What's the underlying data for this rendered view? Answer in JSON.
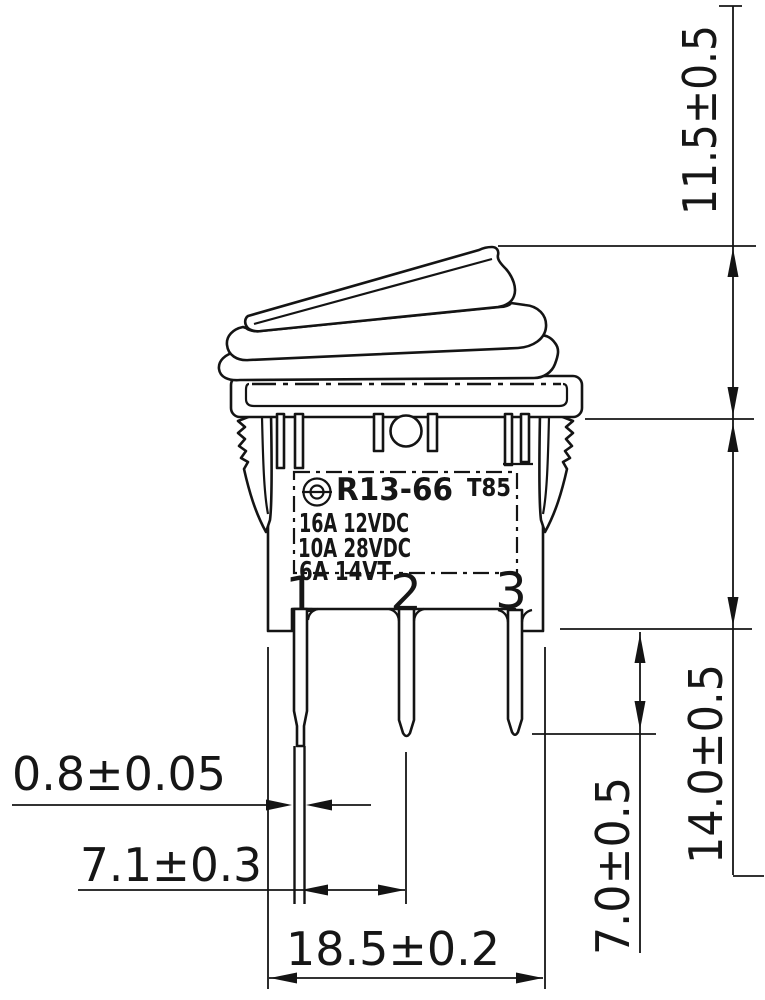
{
  "title": "R13-66 rocker switch dimensional drawing",
  "part_label": {
    "cert_mark": "approval-logo",
    "model": "R13-66",
    "temp_rating": "T85",
    "ratings": [
      "16A 12VDC",
      "10A 28VDC",
      "6A 14VT"
    ]
  },
  "terminals": {
    "t1": "1",
    "t2": "2",
    "t3": "3"
  },
  "dimensions": {
    "rocker_height": "11.5±0.5",
    "body_depth": "14.0±0.5",
    "terminal_length": "7.0±0.5",
    "terminal_thickness": "0.8±0.05",
    "terminal_spacing": "7.1±0.3",
    "body_width": "18.5±0.2"
  }
}
